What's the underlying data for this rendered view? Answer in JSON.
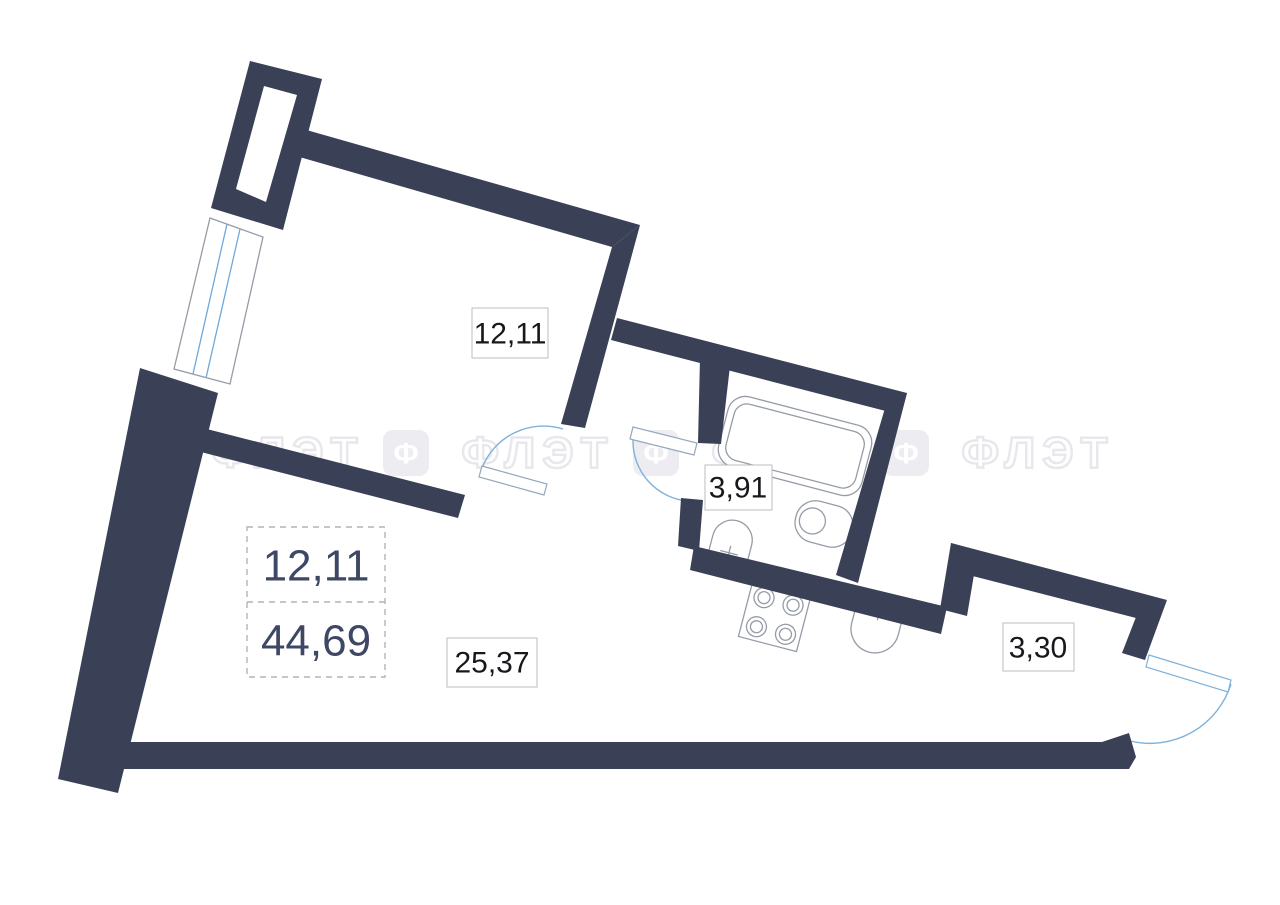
{
  "floor_plan": {
    "type": "studio-apartment-plan",
    "rooms": {
      "bedroom": {
        "area": "12,11"
      },
      "bathroom": {
        "area": "3,91"
      },
      "living_kitchen": {
        "area": "25,37"
      },
      "hall": {
        "area": "3,30"
      }
    },
    "summary": {
      "living_area": "12,11",
      "total_area": "44,69"
    },
    "watermark": {
      "logo_glyph": "Ф",
      "brand": "ФЛЭТ"
    },
    "colors": {
      "wall": "#3a4157",
      "door_arc": "#7fb2da",
      "window_glass": "#6fa8d8",
      "fixture_outline": "#969ca6",
      "summary_text": "#3e4764",
      "label_text": "#17181c",
      "watermark": "#e7e7ec",
      "background": "#ffffff"
    }
  }
}
